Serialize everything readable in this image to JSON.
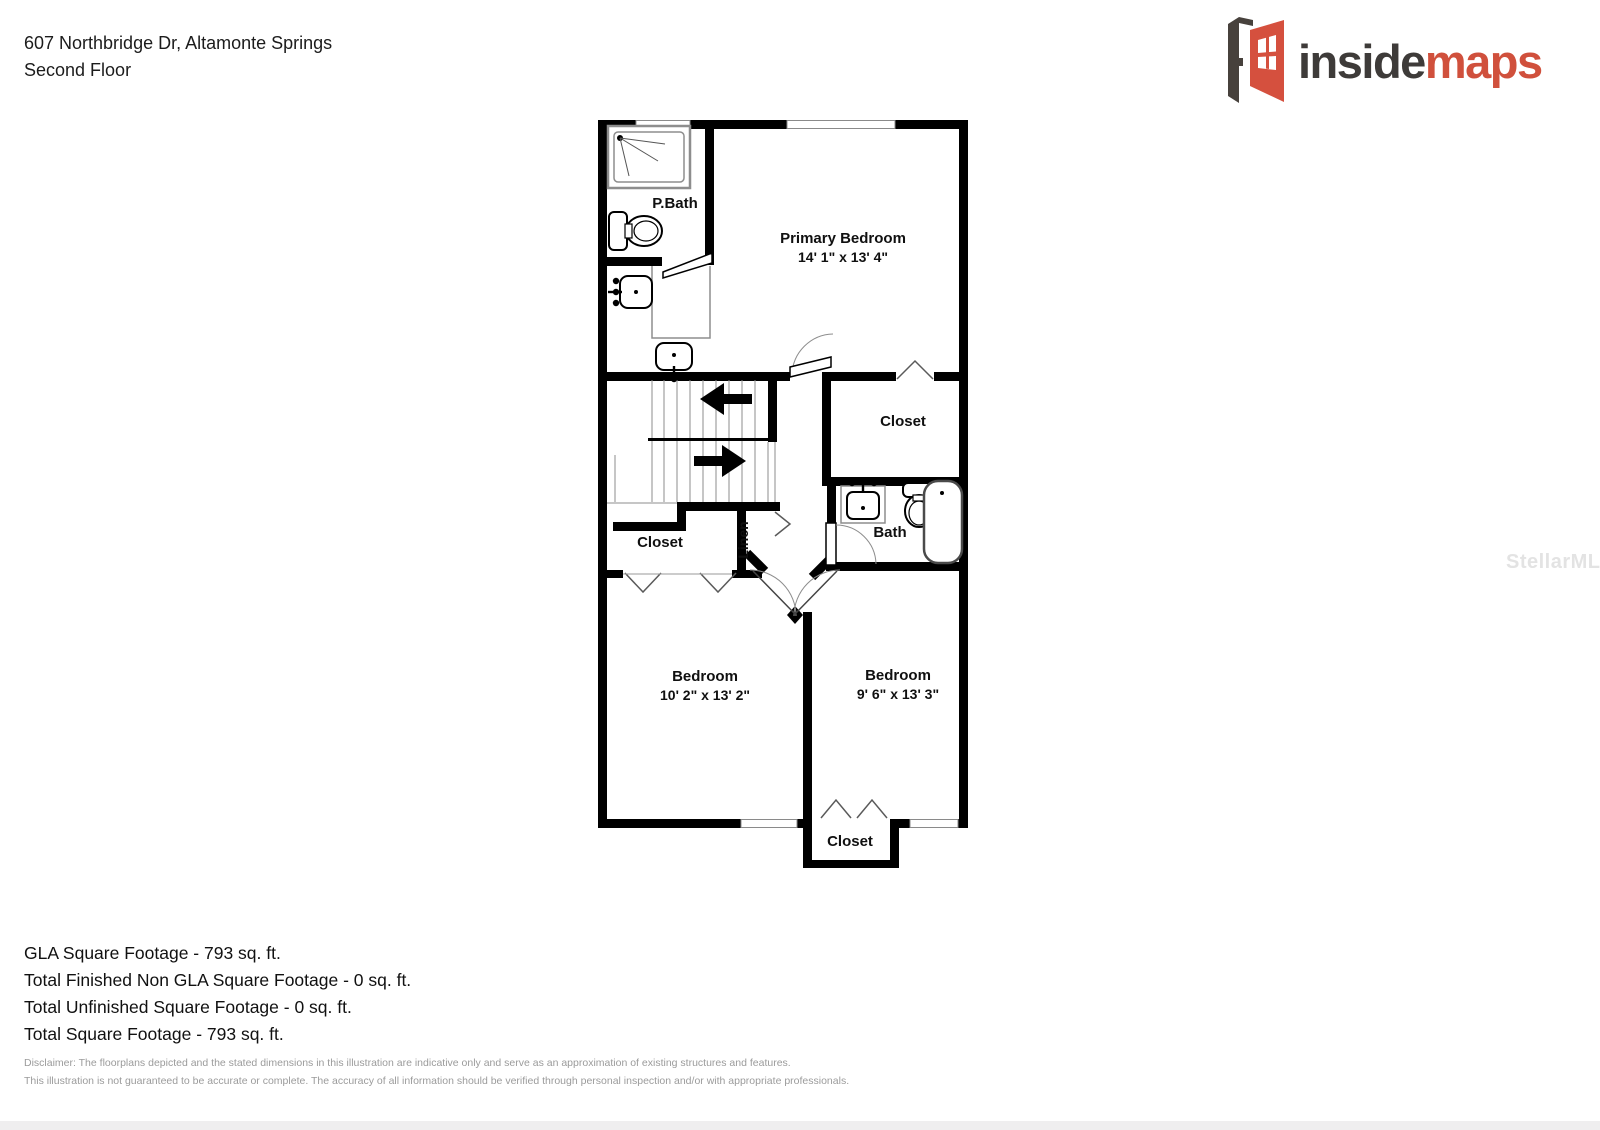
{
  "header": {
    "address": "607 Northbridge Dr, Altamonte Springs",
    "floor": "Second Floor"
  },
  "logo": {
    "inside": "inside",
    "maps": "maps",
    "accent_color": "#d0503c",
    "dark_color": "#3e3b39"
  },
  "watermark": "StellarMLS",
  "floorplan": {
    "rooms": [
      {
        "id": "pbath",
        "label": "P.Bath"
      },
      {
        "id": "primary-bedroom",
        "label": "Primary Bedroom",
        "dims": "14' 1\" x 13' 4\""
      },
      {
        "id": "closet-upper",
        "label": "Closet"
      },
      {
        "id": "bath",
        "label": "Bath"
      },
      {
        "id": "linen",
        "label": "Linen"
      },
      {
        "id": "closet-left",
        "label": "Closet"
      },
      {
        "id": "bedroom-left",
        "label": "Bedroom",
        "dims": "10' 2\" x 13' 2\""
      },
      {
        "id": "bedroom-right",
        "label": "Bedroom",
        "dims": "9' 6\" x 13' 3\""
      },
      {
        "id": "closet-bottom",
        "label": "Closet"
      }
    ]
  },
  "footer": {
    "stats": [
      "GLA Square Footage - 793 sq. ft.",
      "Total Finished Non GLA Square Footage - 0 sq. ft.",
      "Total Unfinished Square Footage - 0 sq. ft.",
      "Total Square Footage - 793 sq. ft."
    ],
    "disclaimer": [
      "Disclaimer: The floorplans depicted and the stated dimensions in this illustration are indicative only and serve as an approximation of existing structures and features.",
      "This illustration is not guaranteed to be accurate or complete. The accuracy of all information should be verified through personal inspection and/or with appropriate professionals."
    ]
  }
}
